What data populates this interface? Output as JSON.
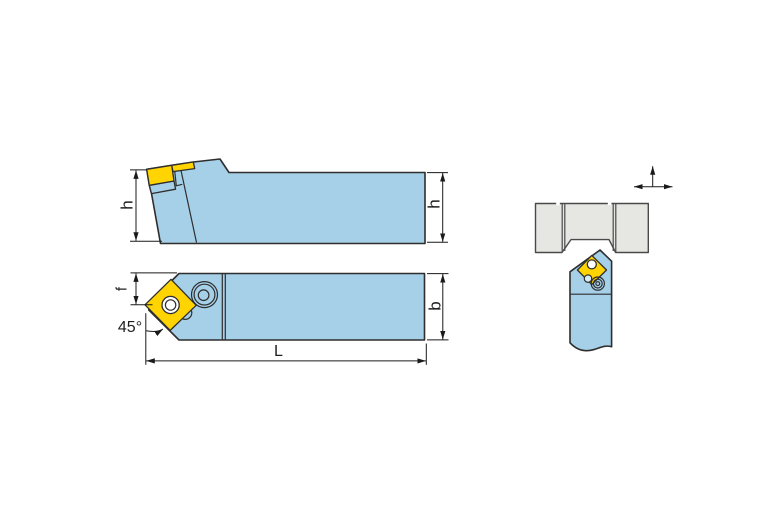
{
  "drawing": {
    "labels": {
      "height_left": "h",
      "height_right": "h",
      "tip_offset": "f",
      "angle": "45°",
      "length": "L",
      "width": "b"
    },
    "colors": {
      "body": "#A6D0E8",
      "insert": "#FFD400",
      "workpiece": "#E6E6E3",
      "outline": "#2E2E2E",
      "dimension_lines": "#1A1A1A",
      "hole": "#FFFFFF"
    },
    "icons": {
      "feed_direction": "feed-direction-arrows"
    }
  }
}
